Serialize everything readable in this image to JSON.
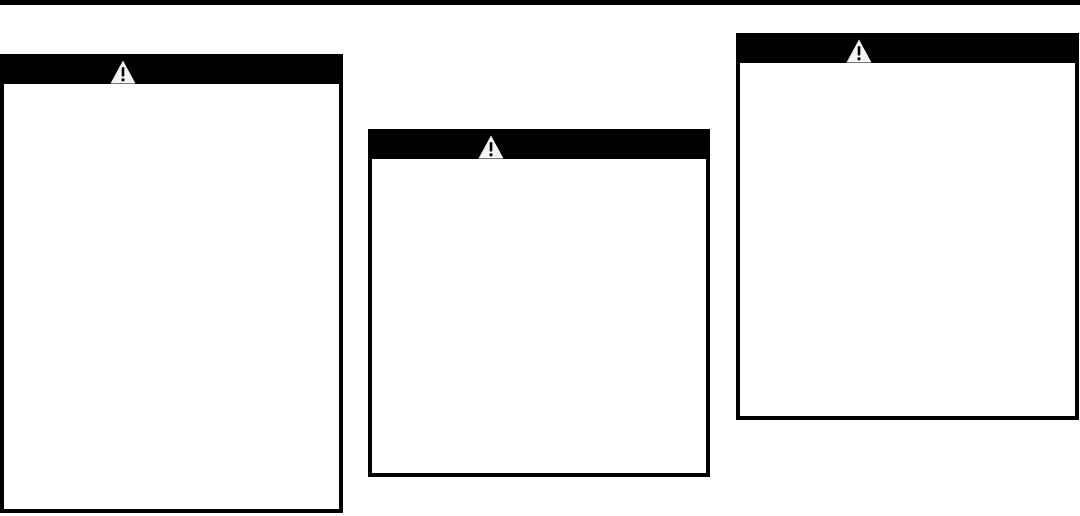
{
  "page": {
    "background_color": "#ffffff",
    "top_rule_color": "#000000"
  },
  "warning_boxes": [
    {
      "position": "left",
      "header": {
        "background_color": "#000000",
        "icon": "warning-triangle-icon"
      },
      "body_text": ""
    },
    {
      "position": "middle",
      "header": {
        "background_color": "#000000",
        "icon": "warning-triangle-icon"
      },
      "body_text": ""
    },
    {
      "position": "right",
      "header": {
        "background_color": "#000000",
        "icon": "warning-triangle-icon"
      },
      "body_text": ""
    }
  ],
  "icon_colors": {
    "triangle_fill": "#f4f4f4",
    "exclamation": "#000000"
  }
}
